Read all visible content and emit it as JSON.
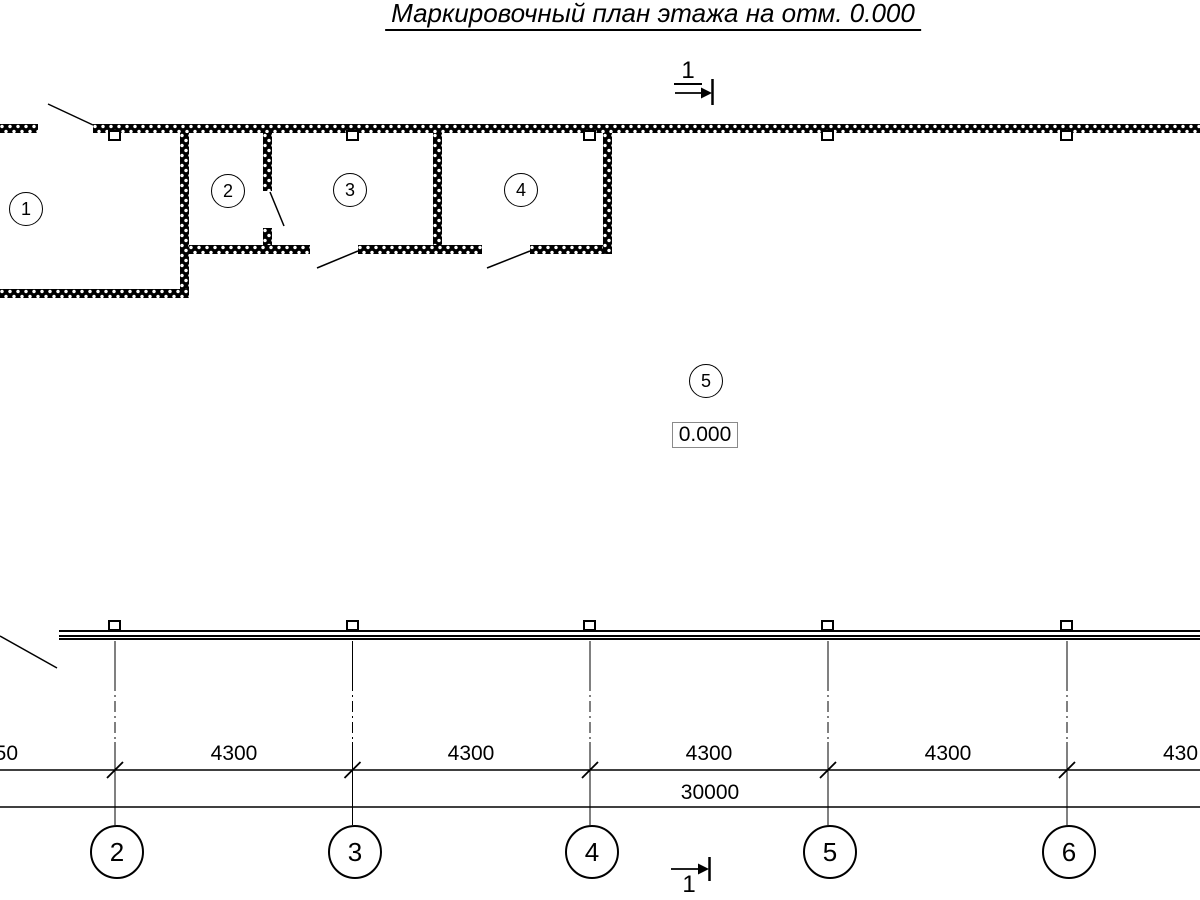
{
  "title": {
    "text": "Маркировочный план этажа на отм. 0.000"
  },
  "rooms": {
    "items": [
      {
        "label": "1"
      },
      {
        "label": "2"
      },
      {
        "label": "3"
      },
      {
        "label": "4"
      },
      {
        "label": "5"
      }
    ]
  },
  "elevation": {
    "value": "0.000"
  },
  "section_mark": {
    "top_label": "1",
    "bottom_label": "1"
  },
  "axes": {
    "items": [
      {
        "label": "2"
      },
      {
        "label": "3"
      },
      {
        "label": "4"
      },
      {
        "label": "5"
      },
      {
        "label": "6"
      }
    ]
  },
  "dimensions": {
    "left_partial": "50",
    "segments": [
      "4300",
      "4300",
      "4300",
      "4300"
    ],
    "right_partial": "430",
    "total": "30000"
  },
  "colors": {
    "line": "#000000",
    "background": "#ffffff",
    "elevation_box_border": "#8a8a8a"
  }
}
